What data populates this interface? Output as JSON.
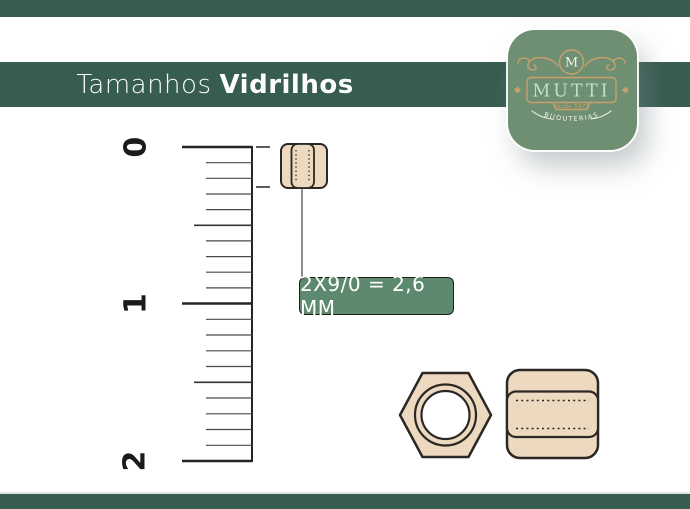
{
  "title": {
    "light": "Tamanhos",
    "bold": "Vidrilhos"
  },
  "logo": {
    "monogram": "M",
    "brand": "MUTTI",
    "since": "desde 1973",
    "tagline": "BIJOUTERIAS"
  },
  "ruler": {
    "numbers": [
      "0",
      "1",
      "2"
    ]
  },
  "measurement": {
    "label": "2X9/0 = 2,6 MM"
  },
  "colors": {
    "green-dark": "#375c50",
    "green-label": "#5d8a6f",
    "green-badge": "#6f8f73",
    "tan": "#ecd9bf",
    "ink": "#26241f",
    "gold": "#c9a06b",
    "mint": "#b9e3c6",
    "cream": "#f5f3ea"
  }
}
